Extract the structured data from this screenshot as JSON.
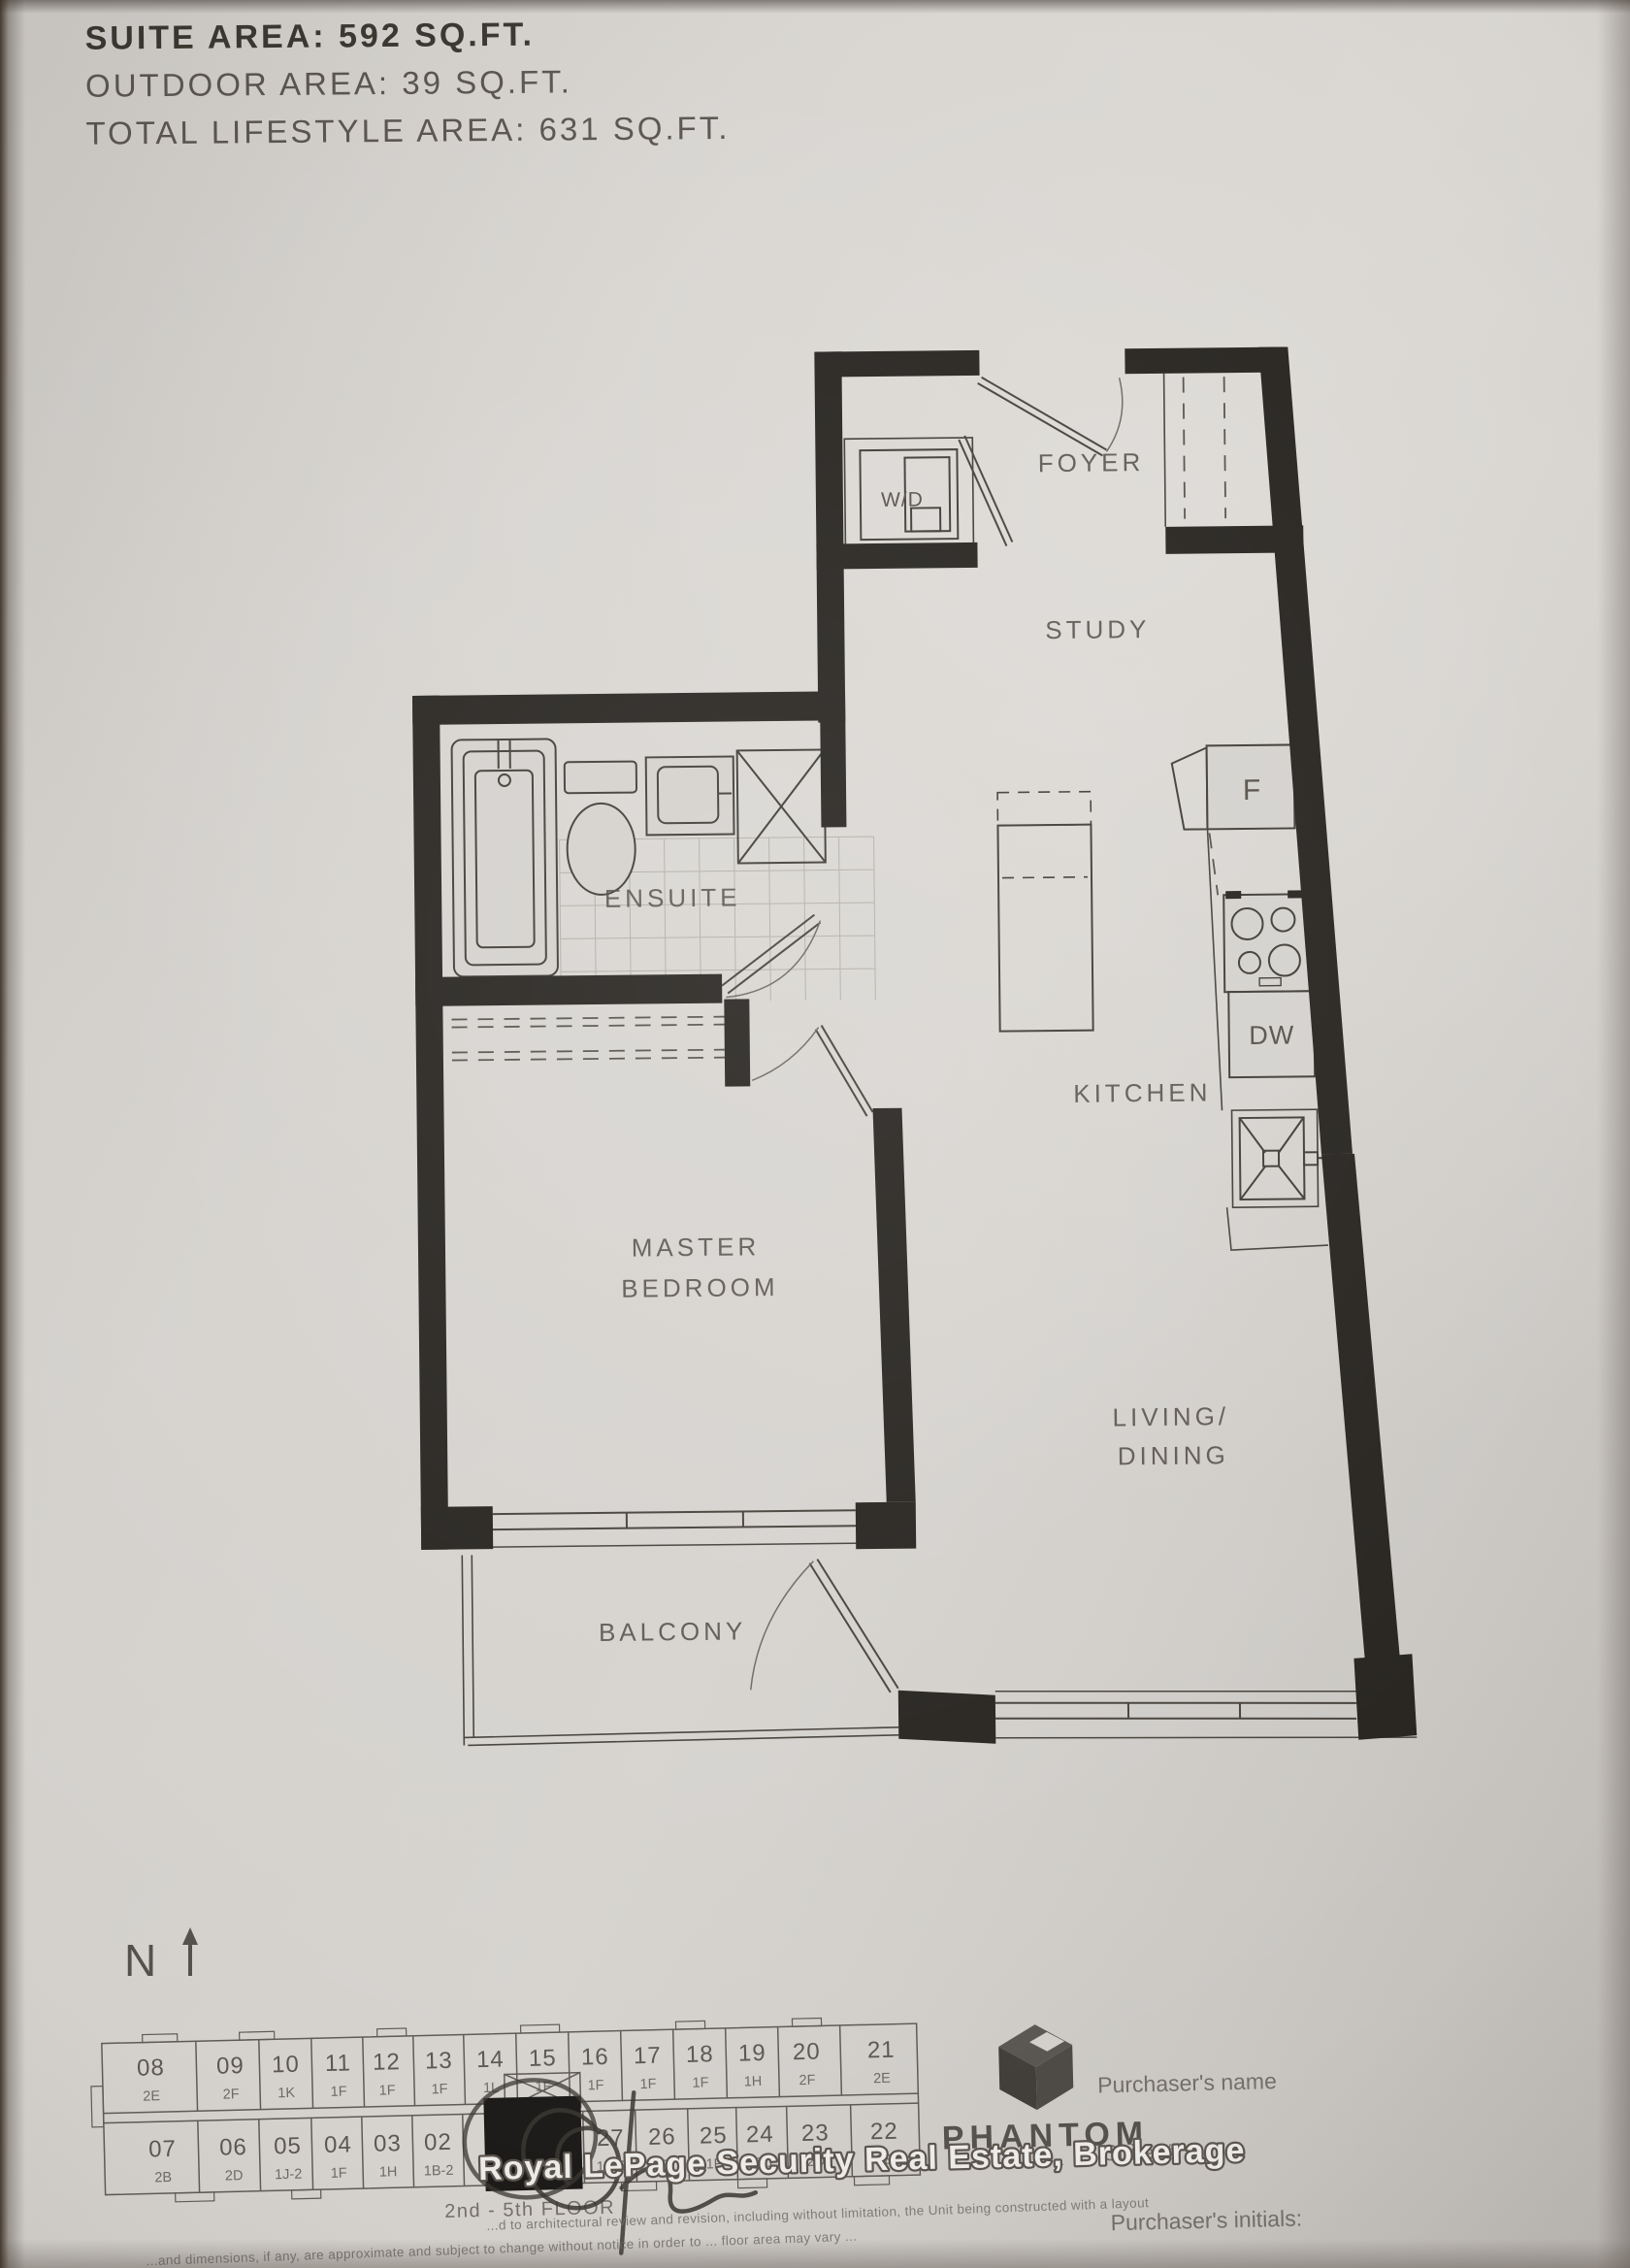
{
  "header": {
    "suite_area": "SUITE AREA: 592 SQ.FT.",
    "outdoor_area": "OUTDOOR AREA: 39 SQ.FT.",
    "total_area": "TOTAL LIFESTYLE AREA: 631 SQ.FT."
  },
  "floor_plan": {
    "rooms": {
      "foyer": "FOYER",
      "study": "STUDY",
      "ensuite": "ENSUITE",
      "kitchen": "KITCHEN",
      "master_bedroom_line1": "MASTER",
      "master_bedroom_line2": "BEDROOM",
      "living_dining_line1": "LIVING/",
      "living_dining_line2": "DINING",
      "balcony": "BALCONY"
    },
    "fixtures": {
      "washer_dryer": "W/D",
      "fridge": "F",
      "dishwasher": "DW"
    }
  },
  "compass": {
    "north_label": "N"
  },
  "key_plan": {
    "floor_caption": "2nd - 5th FLOOR",
    "top_row": [
      {
        "unit": "08",
        "type": "2E"
      },
      {
        "unit": "09",
        "type": "2F"
      },
      {
        "unit": "10",
        "type": "1K"
      },
      {
        "unit": "11",
        "type": "1F"
      },
      {
        "unit": "12",
        "type": "1F"
      },
      {
        "unit": "13",
        "type": "1F"
      },
      {
        "unit": "14",
        "type": "1L"
      },
      {
        "unit": "15",
        "type": "1F"
      },
      {
        "unit": "16",
        "type": "1F"
      },
      {
        "unit": "17",
        "type": "1F"
      },
      {
        "unit": "18",
        "type": "1F"
      },
      {
        "unit": "19",
        "type": "1H"
      },
      {
        "unit": "20",
        "type": "2F"
      },
      {
        "unit": "21",
        "type": "2E"
      }
    ],
    "bottom_row": [
      {
        "unit": "07",
        "type": "2B"
      },
      {
        "unit": "06",
        "type": "2D"
      },
      {
        "unit": "05",
        "type": "1J-2"
      },
      {
        "unit": "04",
        "type": "1F"
      },
      {
        "unit": "03",
        "type": "1H"
      },
      {
        "unit": "02",
        "type": "1B-2"
      },
      {
        "unit": "",
        "type": "",
        "highlighted": true
      },
      {
        "unit": "27",
        "type": "1B-3"
      },
      {
        "unit": "26",
        "type": "1F"
      },
      {
        "unit": "25",
        "type": "1F"
      },
      {
        "unit": "24",
        "type": "1J-1"
      },
      {
        "unit": "23",
        "type": "2D"
      },
      {
        "unit": "22",
        "type": "2E"
      }
    ]
  },
  "branding": {
    "logo_name": "PHANTOM",
    "tagline_illegible": "· · · · · · · · · ·"
  },
  "form": {
    "purchaser_name_label": "Purchaser's name",
    "suite_label": "Suite #:",
    "initials_label": "Purchaser's initials:"
  },
  "watermark": "Royal LePage Security Real Estate, Brokerage",
  "fine_print": {
    "line1": "...d to architectural review and revision, including without limitation, the Unit being constructed with a layout",
    "line2": "...and dimensions, if any, are approximate and subject to change without notice in order to ... floor area may vary ..."
  }
}
